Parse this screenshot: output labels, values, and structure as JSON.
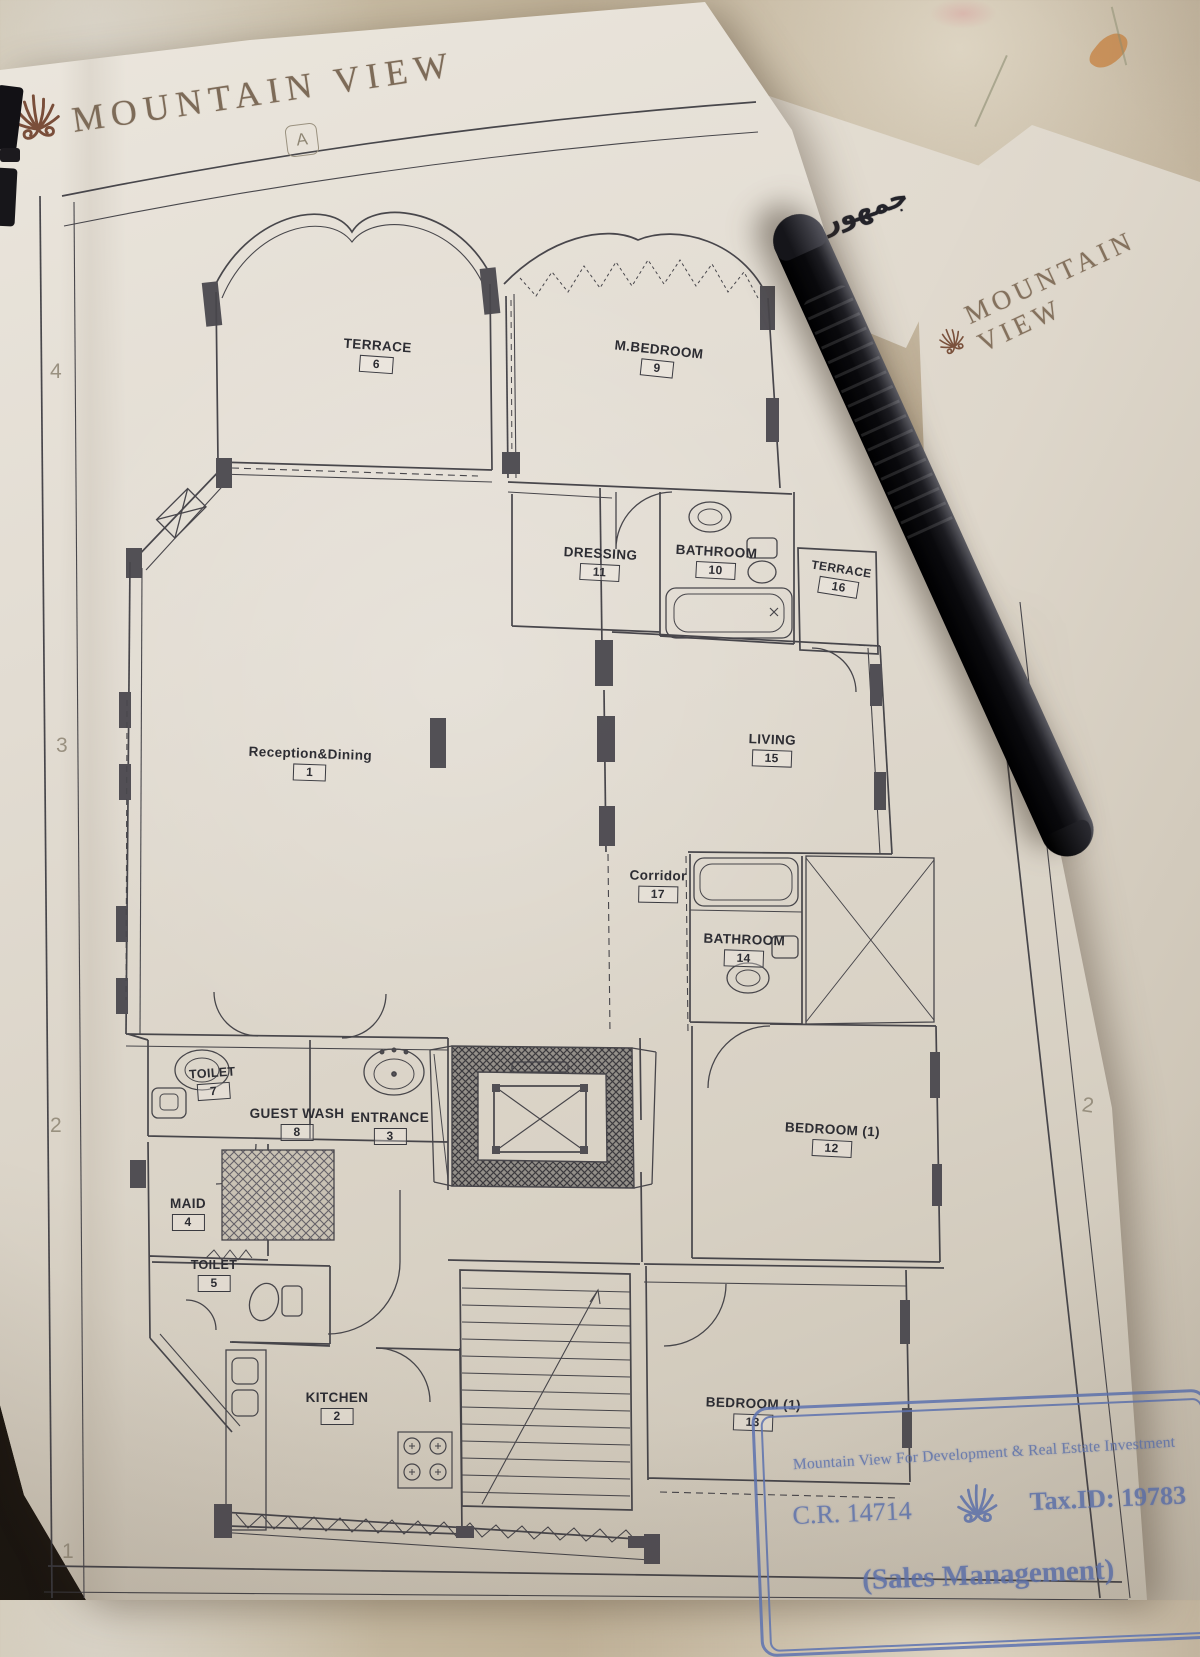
{
  "brand": {
    "name": "MOUNTAIN VIEW"
  },
  "plan": {
    "grid": {
      "top": "A",
      "left": [
        "4",
        "3",
        "2",
        "1"
      ],
      "right": [
        "3",
        "2"
      ]
    },
    "rooms": [
      {
        "name": "TERRACE",
        "num": "6"
      },
      {
        "name": "M.BEDROOM",
        "num": "9"
      },
      {
        "name": "DRESSING",
        "num": "11"
      },
      {
        "name": "BATHROOM",
        "num": "10"
      },
      {
        "name": "TERRACE",
        "num": "16"
      },
      {
        "name": "Reception&Dining",
        "num": "1"
      },
      {
        "name": "LIVING",
        "num": "15"
      },
      {
        "name": "Corridor",
        "num": "17"
      },
      {
        "name": "BATHROOM",
        "num": "14"
      },
      {
        "name": "BEDROOM (1)",
        "num": "12"
      },
      {
        "name": "TOILET",
        "num": "7"
      },
      {
        "name": "GUEST WASH",
        "num": "8"
      },
      {
        "name": "ENTRANCE",
        "num": "3"
      },
      {
        "name": "MAID",
        "num": "4"
      },
      {
        "name": "TOILET",
        "num": "5"
      },
      {
        "name": "KITCHEN",
        "num": "2"
      },
      {
        "name": "BEDROOM (1)",
        "num": "13"
      }
    ]
  },
  "side_sheet": {
    "brand": "MOUNTAIN VIEW"
  },
  "note": {
    "arabic": "جمهورية"
  },
  "stamp": {
    "line1": "Mountain View For Development & Real Estate Investment",
    "cr": "C.R. 14714",
    "tax_id": "Tax.ID: 19783",
    "line3": "(Sales Management)"
  },
  "colors": {
    "stamp_ink": "#5d73b1",
    "brand_text": "#7d6b58",
    "brand_icon": "#7a4e3a"
  }
}
